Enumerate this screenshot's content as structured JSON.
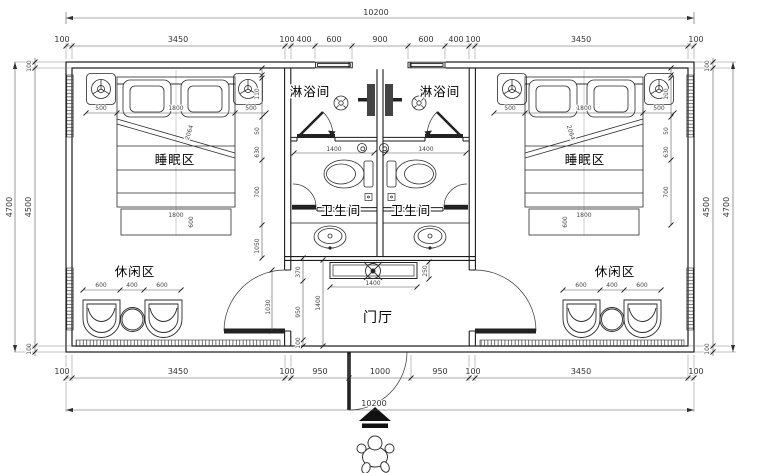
{
  "plan": {
    "rooms": {
      "sleep": "睡眠区",
      "shower": "淋浴间",
      "wc": "卫生间",
      "lounge": "休闲区",
      "foyer": "门厅"
    },
    "totals": {
      "width": "10200",
      "height_outer": "4700"
    },
    "top_chain": [
      "100",
      "3450",
      "100",
      "400",
      "600",
      "900",
      "600",
      "400",
      "100",
      "3450",
      "100"
    ],
    "bottom_chain": [
      "100",
      "3450",
      "100",
      "950",
      "1000",
      "950",
      "100",
      "3450",
      "100"
    ],
    "side_chain": [
      "100",
      "4500",
      "100"
    ],
    "bed": {
      "side": "500",
      "width": "1800",
      "diag": "2064",
      "foot_w": "1800",
      "foot_d": "600"
    },
    "lounge_dims": [
      "600",
      "400",
      "600"
    ],
    "bath": {
      "width": "1400"
    },
    "counter": {
      "width": "1400",
      "depth": "250"
    },
    "foyer_dims": {
      "chain": [
        "370",
        "950",
        "100"
      ],
      "height": "1400",
      "door": "1030"
    },
    "wall_chain": [
      "110",
      "50",
      "630",
      "700",
      "1050"
    ]
  }
}
